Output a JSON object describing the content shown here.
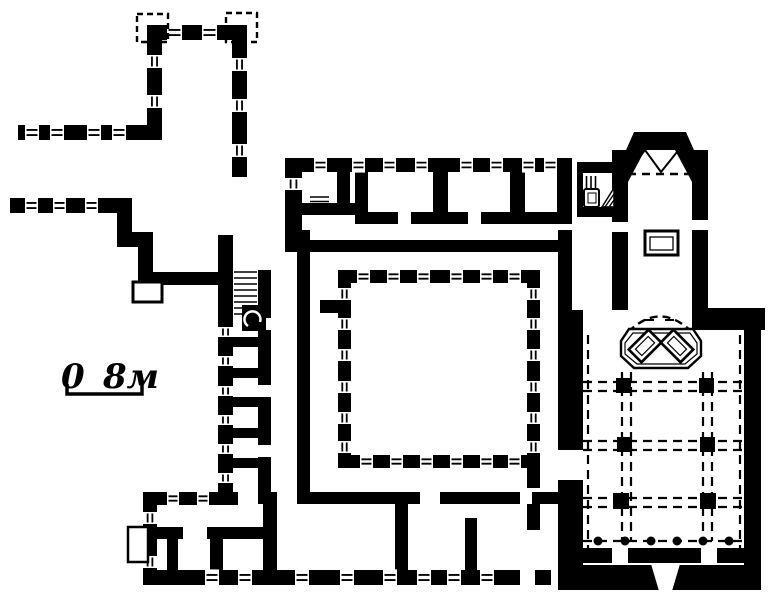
{
  "scale_bar": {
    "zero_label": "0",
    "length_label": "8м"
  },
  "colors": {
    "ink": "#000000",
    "paper": "#ffffff"
  }
}
